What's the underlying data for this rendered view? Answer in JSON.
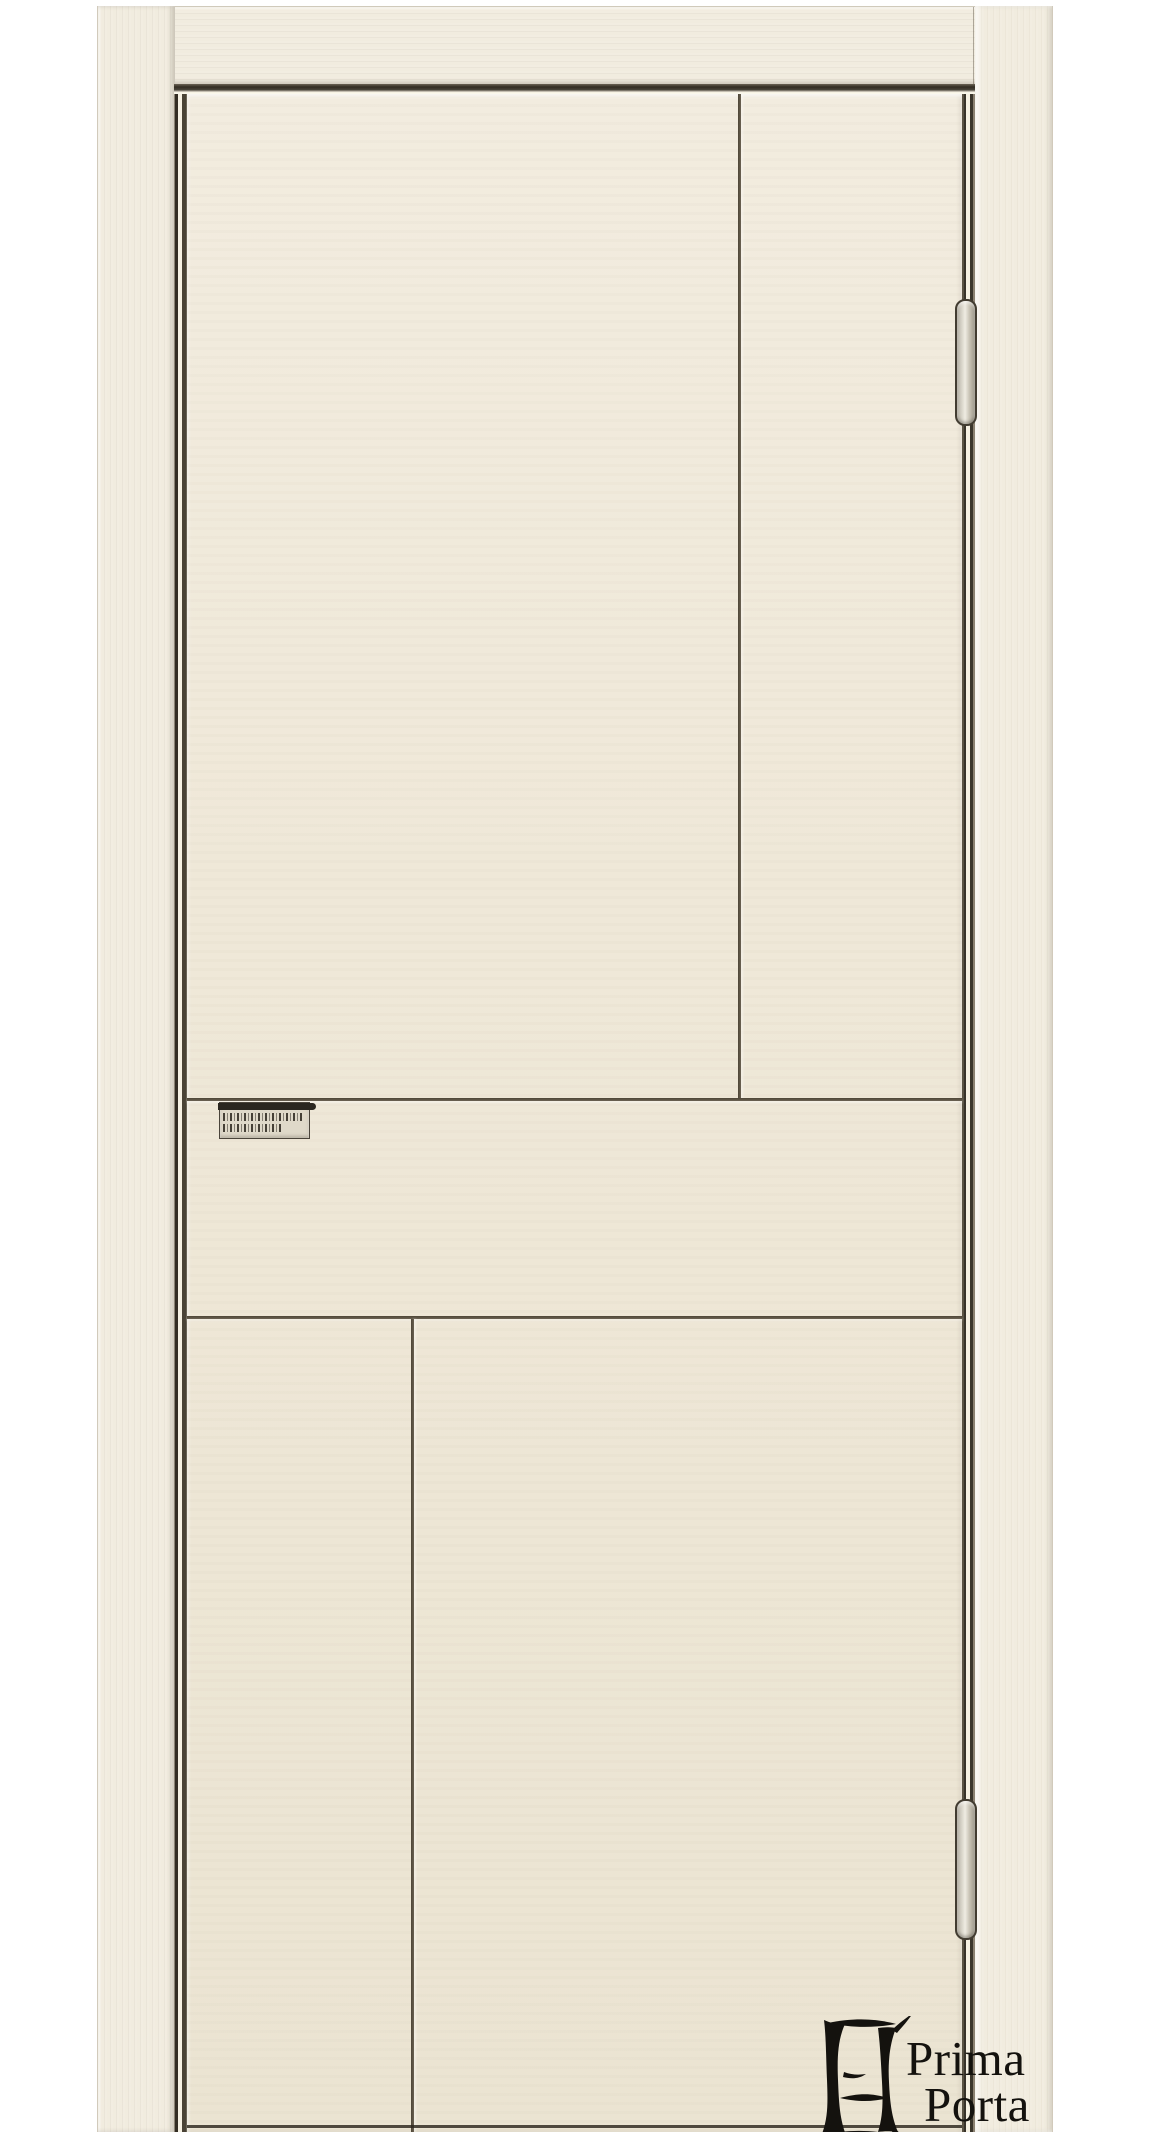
{
  "photo": {
    "type": "product-photo",
    "subject": "Cream painted interior door with recessed geometric grooves, concealed hinges and engraved lock plate, shown in a matching door frame on a white background"
  },
  "brand": {
    "name": "Prima Porta",
    "line1": "Prima",
    "line2": "Porta"
  },
  "colors": {
    "bg": "#ffffff",
    "frame": "#f1ecdf",
    "frame-edge": "#d9d2c1",
    "door": "#efe8d8",
    "door-light": "#f2ecdf",
    "door-dark": "#ebe4d2",
    "groove": "#453e30",
    "gap-dark": "#332d23",
    "gap-light": "#f6f1e3",
    "hinge-metal": "#c7c2b4",
    "hinge-outline": "#423c31",
    "logo-ink": "#14120e",
    "plate": "#dfd9c9"
  }
}
